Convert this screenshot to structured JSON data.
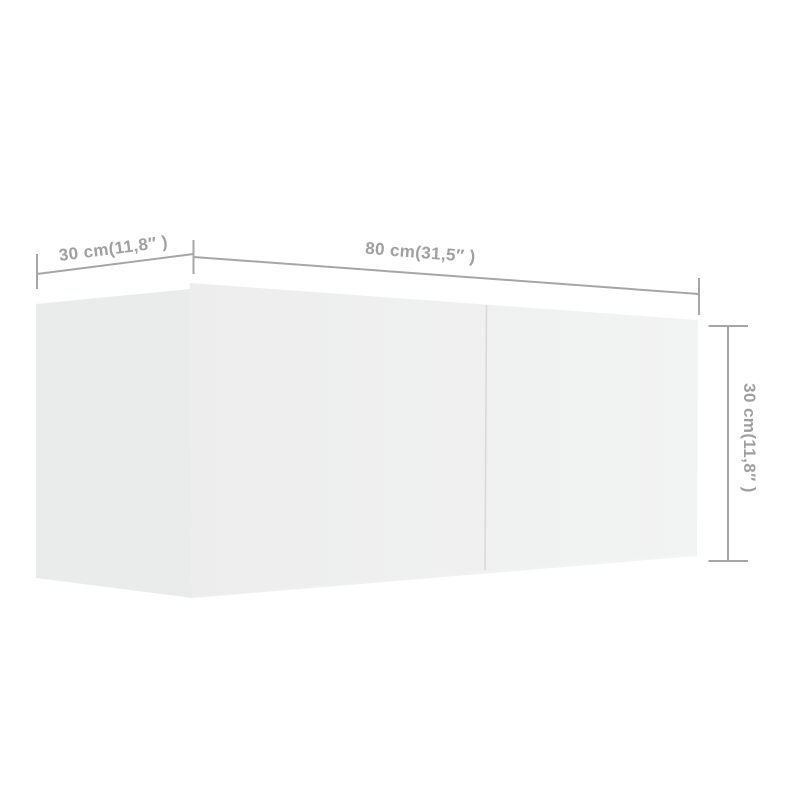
{
  "figure": {
    "type": "product-dimension-diagram",
    "subject": "white wall-mounted TV cabinet, two front panels, shown in perspective"
  },
  "dimensions": {
    "depth": {
      "value_cm": 30,
      "value_inch": "11,8",
      "label": "30 cm(11,8″ )"
    },
    "width": {
      "value_cm": 80,
      "value_inch": "31,5",
      "label": "80 cm(31,5″ )"
    },
    "height": {
      "value_cm": 30,
      "value_inch": "11,8",
      "label": "30 cm(11,8″ )"
    }
  },
  "colors": {
    "background": "#ffffff",
    "line": "#a6a6a6",
    "label": "#a0a0a0",
    "face_side": "#eaebeb",
    "face_front_left": "#ededed",
    "face_front_right": "#f2f3f3",
    "seam": "#d8d9d9"
  }
}
